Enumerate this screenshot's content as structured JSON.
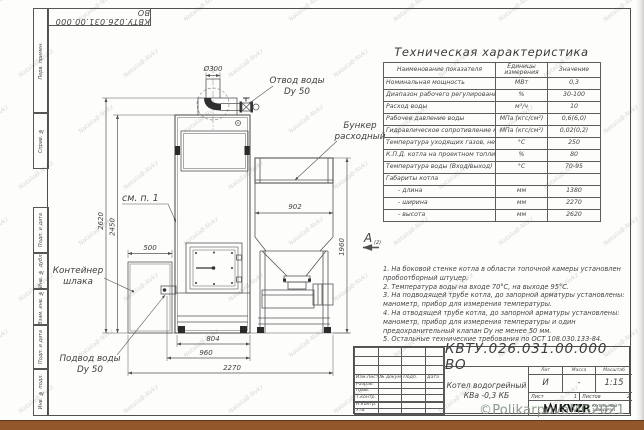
{
  "doc_number": "КВТУ.026.031.00.000 ВО",
  "frame": {
    "margin_labels": [
      "Перв. примен.",
      "Справ. №",
      "Подп. и дата",
      "Инв. № дубл.",
      "Взам. инв. №",
      "Подп. и дата",
      "Инв. № подл."
    ]
  },
  "spec_table": {
    "title": "Техническая характеристика",
    "col_name": "Наименование показателя",
    "col_units": "Единицы измерения",
    "col_value": "Значение",
    "rows": [
      {
        "name": "Номинальная мощность",
        "units": "МВт",
        "value": "0,3"
      },
      {
        "name": "Диапазон рабочего регулирования",
        "units": "%",
        "value": "30-100"
      },
      {
        "name": "Расход воды",
        "units": "м³/ч",
        "value": "10"
      },
      {
        "name": "Рабочее давление воды",
        "units": "МПа (кгс/см²)",
        "value": "0,6(6,0)"
      },
      {
        "name": "Гидравлическое сопротивление котла",
        "units": "МПа (кгс/см²)",
        "value": "0,02(0,2)"
      },
      {
        "name": "Температура уходящих газов, не более",
        "units": "°С",
        "value": "250"
      },
      {
        "name": "К.П.Д. котла на проектном топливе",
        "units": "%",
        "value": "80"
      },
      {
        "name": "Температура воды (Вход/выход)",
        "units": "°С",
        "value": "70-95"
      },
      {
        "name": "Габариты котла",
        "units": "",
        "value": ""
      },
      {
        "name": "- длина",
        "units": "мм",
        "value": "1380"
      },
      {
        "name": "- ширина",
        "units": "мм",
        "value": "2270"
      },
      {
        "name": "- высота",
        "units": "мм",
        "value": "2620"
      }
    ]
  },
  "notes": [
    "1. На боковой стенке котла в области топочной камеры установлен пробоотборный штуцер.",
    "2. Температура воды на входе 70°С, на выходе 95°С.",
    "3. На подводящей трубе котла, до запорной арматуры установлены: манометр, прибор для измерения температуры.",
    "4. На отводящей трубе котла, до запорной арматуры установлены: манометр, прибор для измерения температуры и один предохранительный клапан Dу не менее 50 мм.",
    "5. Остальные технические требования по ОСТ 108.030.133-84."
  ],
  "title_block": {
    "product_line1": "Котел водогрейный",
    "product_line2": "КВа -0,3 КБ",
    "col_izm": "Изм.Лист",
    "col_doc": "№ докум.",
    "col_podp": "Подп.",
    "col_data": "Дата",
    "rows": [
      "Разраб.",
      "Пров.",
      "Т.контр.",
      "",
      "Н.контр.",
      "Утв."
    ],
    "lit_h": "Лит",
    "mass_h": "Масса",
    "scale_h": "Масштаб",
    "lit_v": "И",
    "mass_v": "-",
    "scale_v": "1:15",
    "sheet_h": "Лист",
    "sheet_v": "1",
    "sheets_h": "Листов",
    "sheets_v": "2",
    "logo_text": "KVZR",
    "logo_sub1": "КОТЕЛЬНЫЙ",
    "logo_sub2": "ЗАВОД РЭП"
  },
  "drawing": {
    "labels": {
      "otvod1": "Отвод воды",
      "otvod2": "Dy 50",
      "bunker1": "Бункер",
      "bunker2": "расходный",
      "see_item": "см. п. 1",
      "container1": "Контейнер",
      "container2": "шлака",
      "podvod1": "Подвод воды",
      "podvod2": "Dy 50",
      "view": "А",
      "view_sheet": "(2)"
    },
    "dims": {
      "d300": "Ø300",
      "h2620": "2620",
      "h2450": "2450",
      "w500": "500",
      "w902": "902",
      "h1960": "1960",
      "w804": "804",
      "w960": "960",
      "w2270": "2270"
    }
  },
  "watermarks": {
    "copyright": "©PolikarpovaMG2021",
    "tile": "NataliaB-Nvkz"
  }
}
